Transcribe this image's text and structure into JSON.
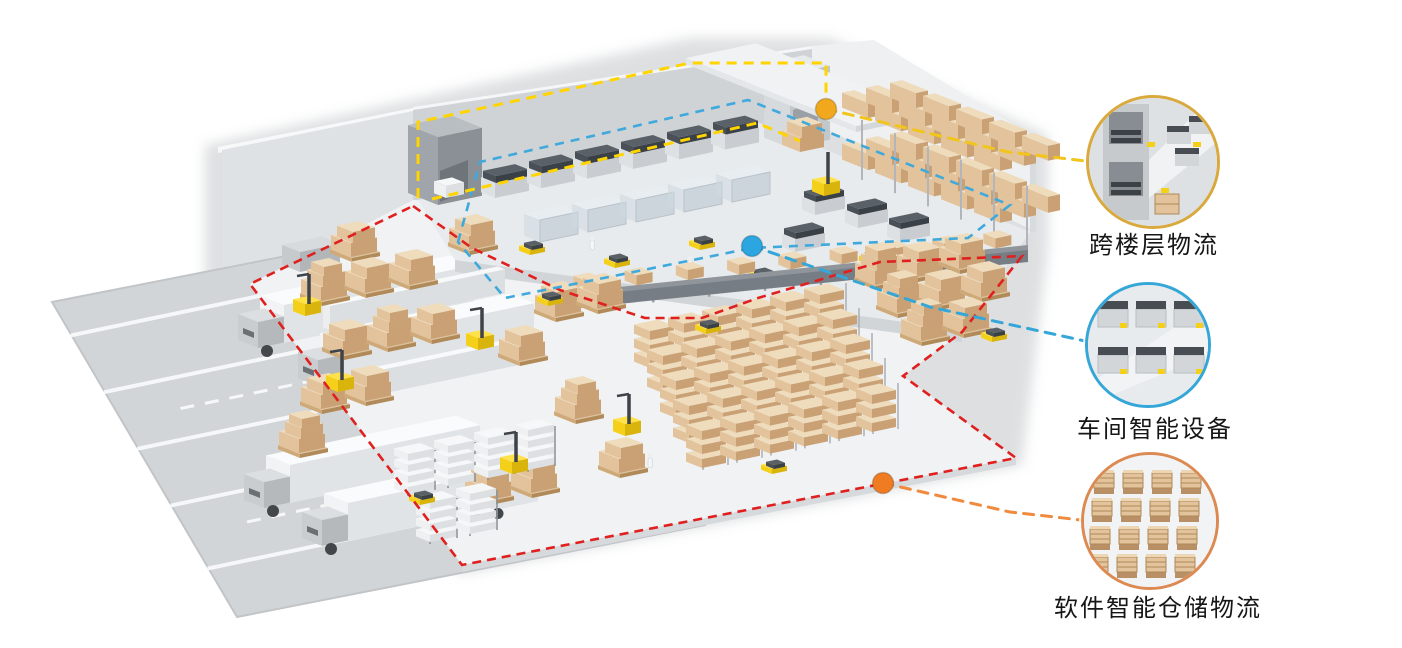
{
  "callouts": [
    {
      "id": "cross-floor-logistics",
      "label": "跨楼层物流",
      "ring_color": "#d9a93c",
      "connector_color": "#f2c51d",
      "dot_color": "#f2a81d"
    },
    {
      "id": "workshop-smart-equipment",
      "label": "车间智能设备",
      "ring_color": "#35a6d8",
      "connector_color": "#35a6d8",
      "dot_color": "#2ba6e0"
    },
    {
      "id": "software-smart-warehouse-logistics",
      "label": "软件智能仓储物流",
      "ring_color": "#dd8a52",
      "connector_color": "#ef8a3e",
      "dot_color": "#f07c22"
    }
  ],
  "boundaries": {
    "outer_red": "#e0201f",
    "upper_yellow": "#ffd400",
    "workshop_blue": "#3fa9dc"
  },
  "palette": {
    "floor": "#f0f2f3",
    "wall": "#d9dcdf",
    "box_tan": "#e2c39c",
    "agv_yellow": "#f4d01a",
    "truck_gray": "#c9cdd0",
    "shelf_gray": "#c6cacd"
  }
}
